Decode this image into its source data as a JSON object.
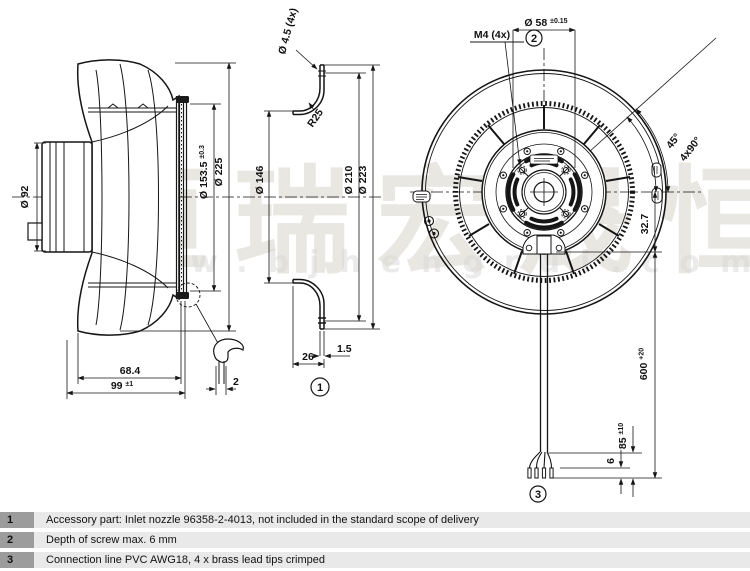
{
  "watermark": {
    "brand_cn": "恒瑞宏晟恒",
    "website": "www.bjhengrui.com"
  },
  "views": {
    "side": {
      "d92": "Ø 92",
      "d153": "Ø 153.5",
      "d153_tol": "±0.3",
      "d225": "Ø 225",
      "w684": "68.4",
      "w99": "99",
      "w99_tol": "±1",
      "clip_thickness": "2"
    },
    "section": {
      "holes": "Ø 4.5 (4x)",
      "r25": "R25",
      "d146": "Ø 146",
      "d210": "Ø 210",
      "d223": "Ø 223",
      "t15": "1.5",
      "depth": "26",
      "item1": "1"
    },
    "front": {
      "d58": "Ø 58",
      "d58_tol": "±0.15",
      "m4": "M4 (4x)",
      "item2": "2",
      "a45": "45°",
      "a90": "4x90°",
      "off327": "32.7",
      "cable600": "600",
      "cable600_tol": "+20",
      "strip85": "85",
      "strip85_tol": "±10",
      "tip6": "6",
      "item3": "3"
    }
  },
  "legend": {
    "rows": [
      {
        "no": "1",
        "text": "Accessory part: Inlet nozzle 96358-2-4013, not included in the standard scope of delivery"
      },
      {
        "no": "2",
        "text": "Depth of screw max. 6 mm"
      },
      {
        "no": "3",
        "text": "Connection line PVC AWG18, 4 x brass lead tips crimped"
      }
    ]
  },
  "colors": {
    "line": "#151515",
    "watermark": "#d8d4cc",
    "legend_no_bg": "#9c9c9c",
    "legend_row_bg": "#e9e9e9"
  }
}
